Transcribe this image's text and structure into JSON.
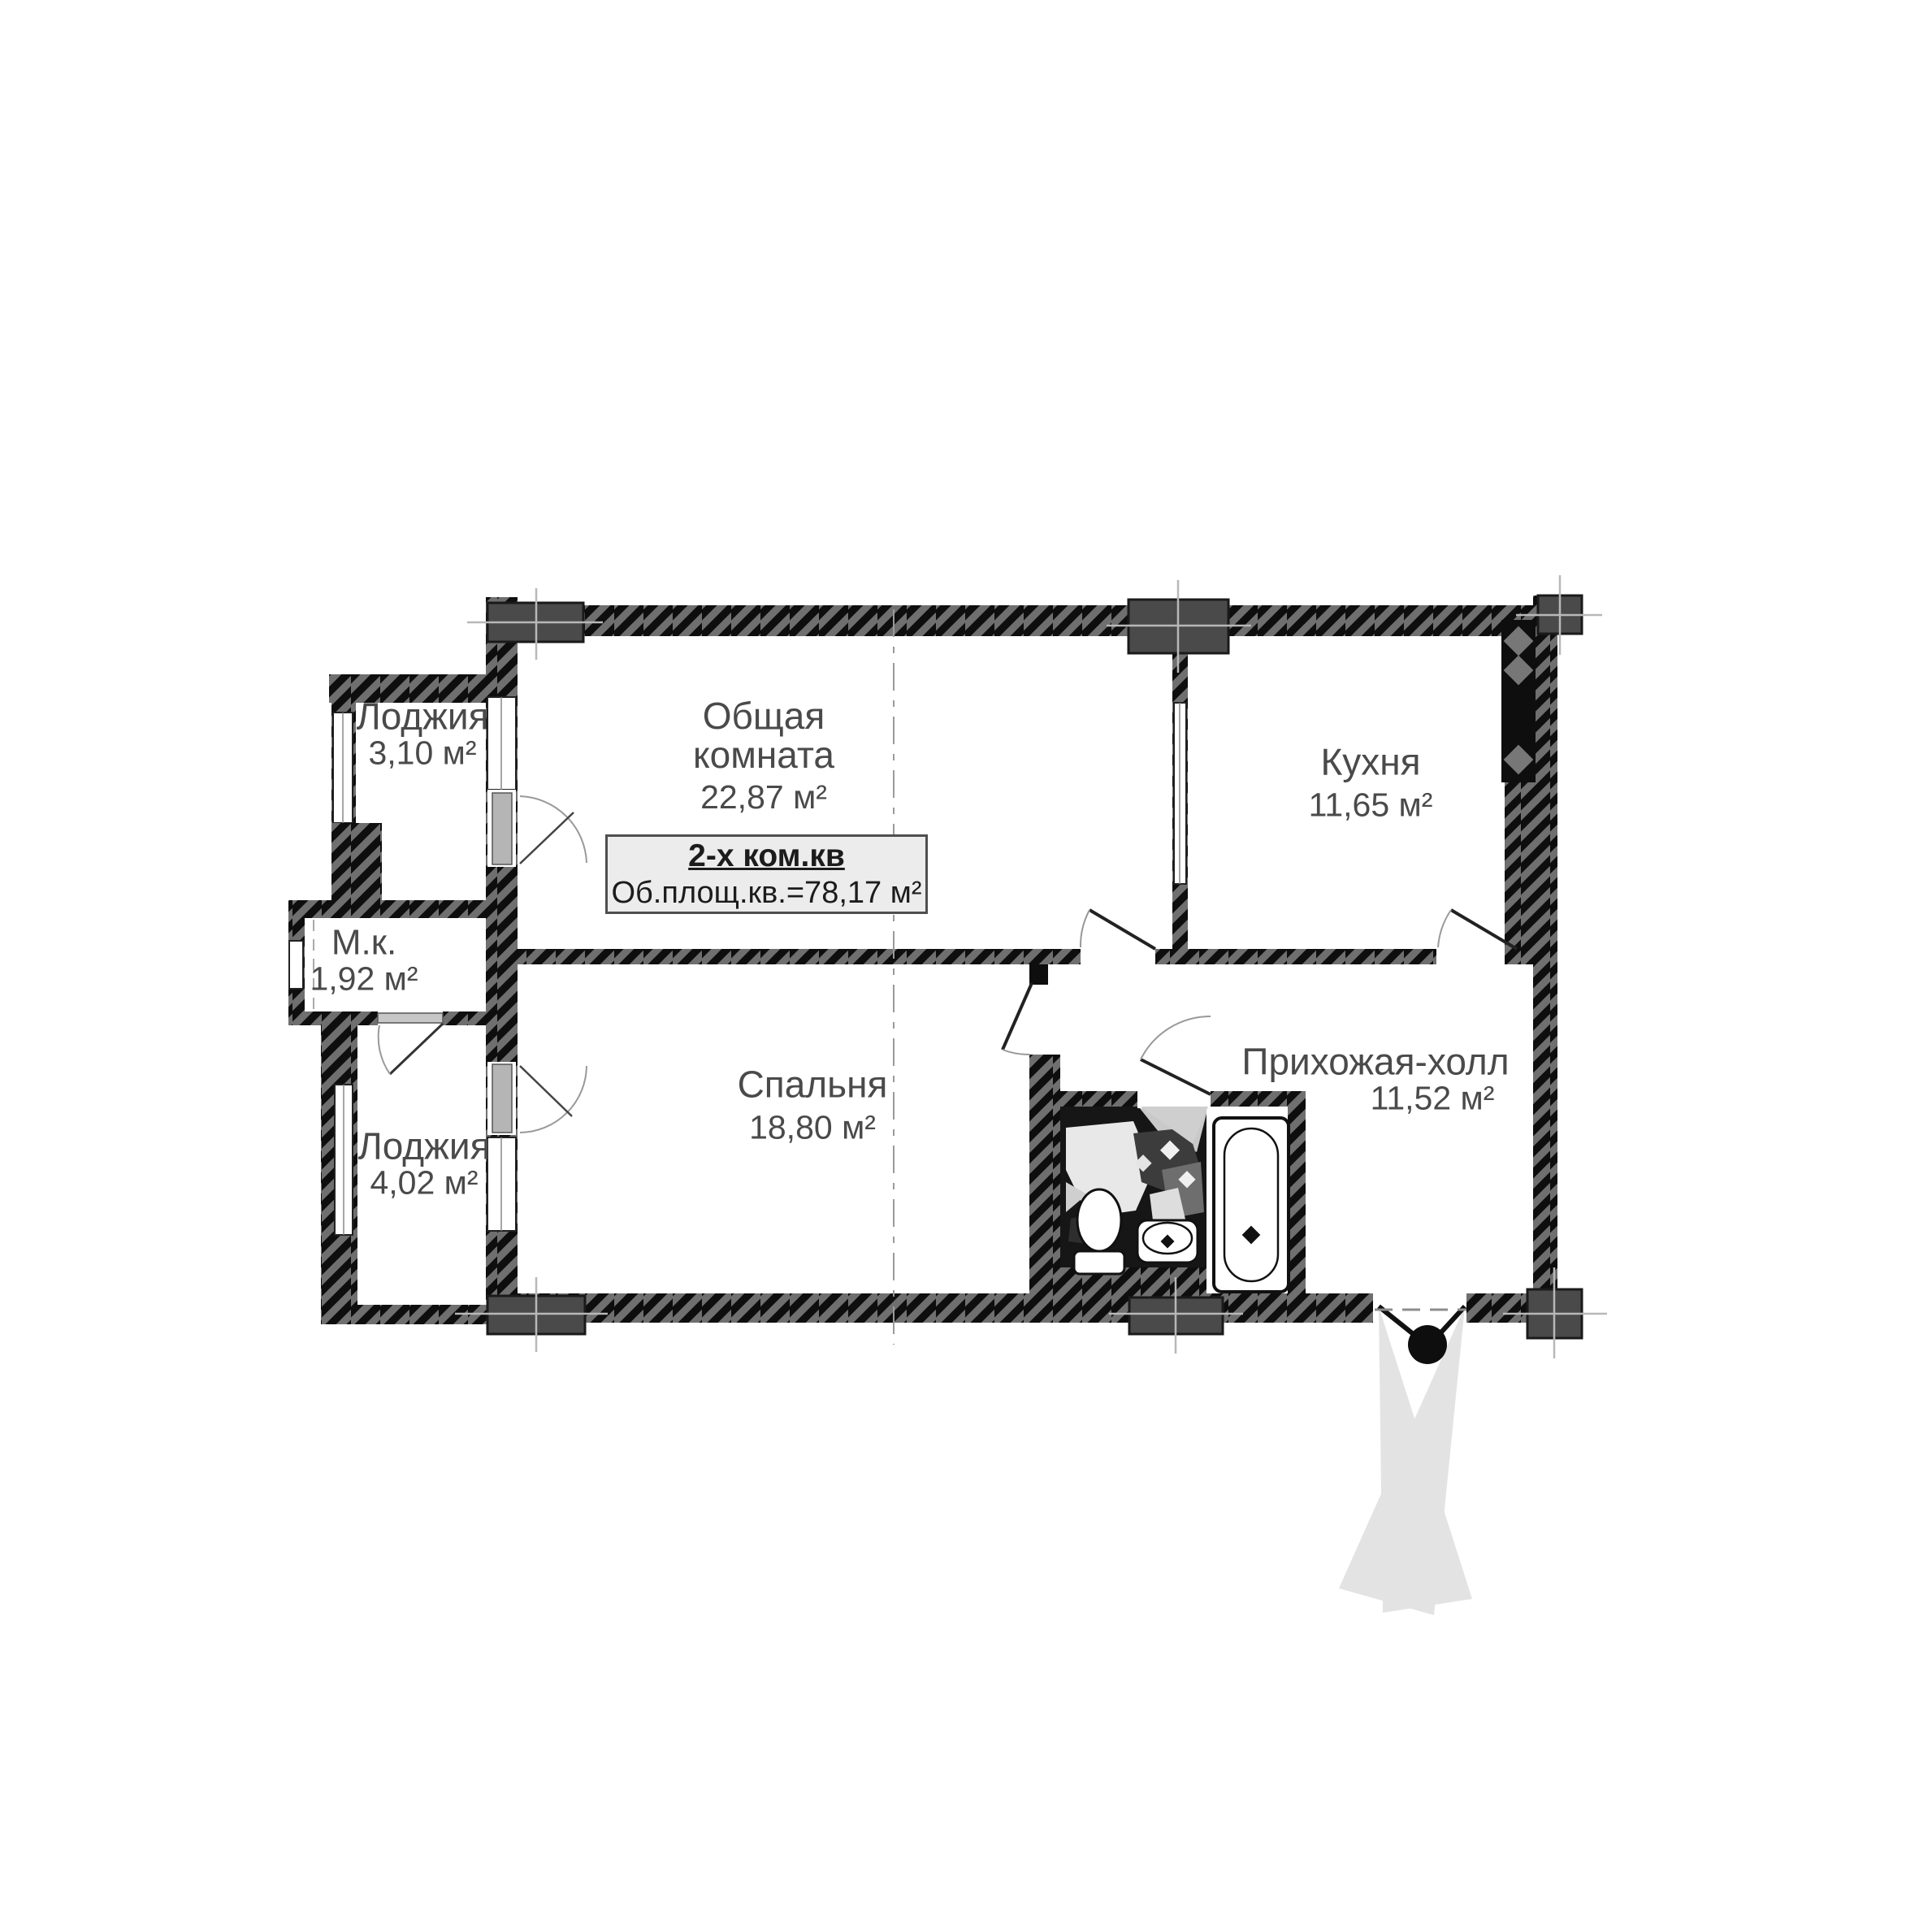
{
  "plan": {
    "kind": "apartment-floor-plan",
    "info_box": {
      "title": "2-х ком.кв",
      "subtitle": "Об.площ.кв.=78,17 м²"
    },
    "rooms": [
      {
        "id": "loggia-top",
        "name": "Лоджия",
        "area": "3,10 м²"
      },
      {
        "id": "mk",
        "name": "М.к.",
        "area": "1,92 м²"
      },
      {
        "id": "loggia-bottom",
        "name": "Лоджия",
        "area": "4,02 м²"
      },
      {
        "id": "living-room",
        "line1": "Общая",
        "line2": "комната",
        "area": "22,87 м²"
      },
      {
        "id": "kitchen",
        "name": "Кухня",
        "area": "11,65 м²"
      },
      {
        "id": "bedroom",
        "name": "Спальня",
        "area": "18,80 м²"
      },
      {
        "id": "hallway",
        "name": "Прихожая-холл",
        "area": "11,52 м²"
      }
    ],
    "fixtures": [
      "bathtub",
      "toilet",
      "sink",
      "ventilation-shaft",
      "entrance-double-door"
    ],
    "colors": {
      "wall": "#101010",
      "hatch": "#6f6f6f",
      "pillar": "#4a4a4a",
      "door_fan": "#e3e3e3",
      "text": "#4a4a4a",
      "box_bg": "#ececec"
    }
  }
}
